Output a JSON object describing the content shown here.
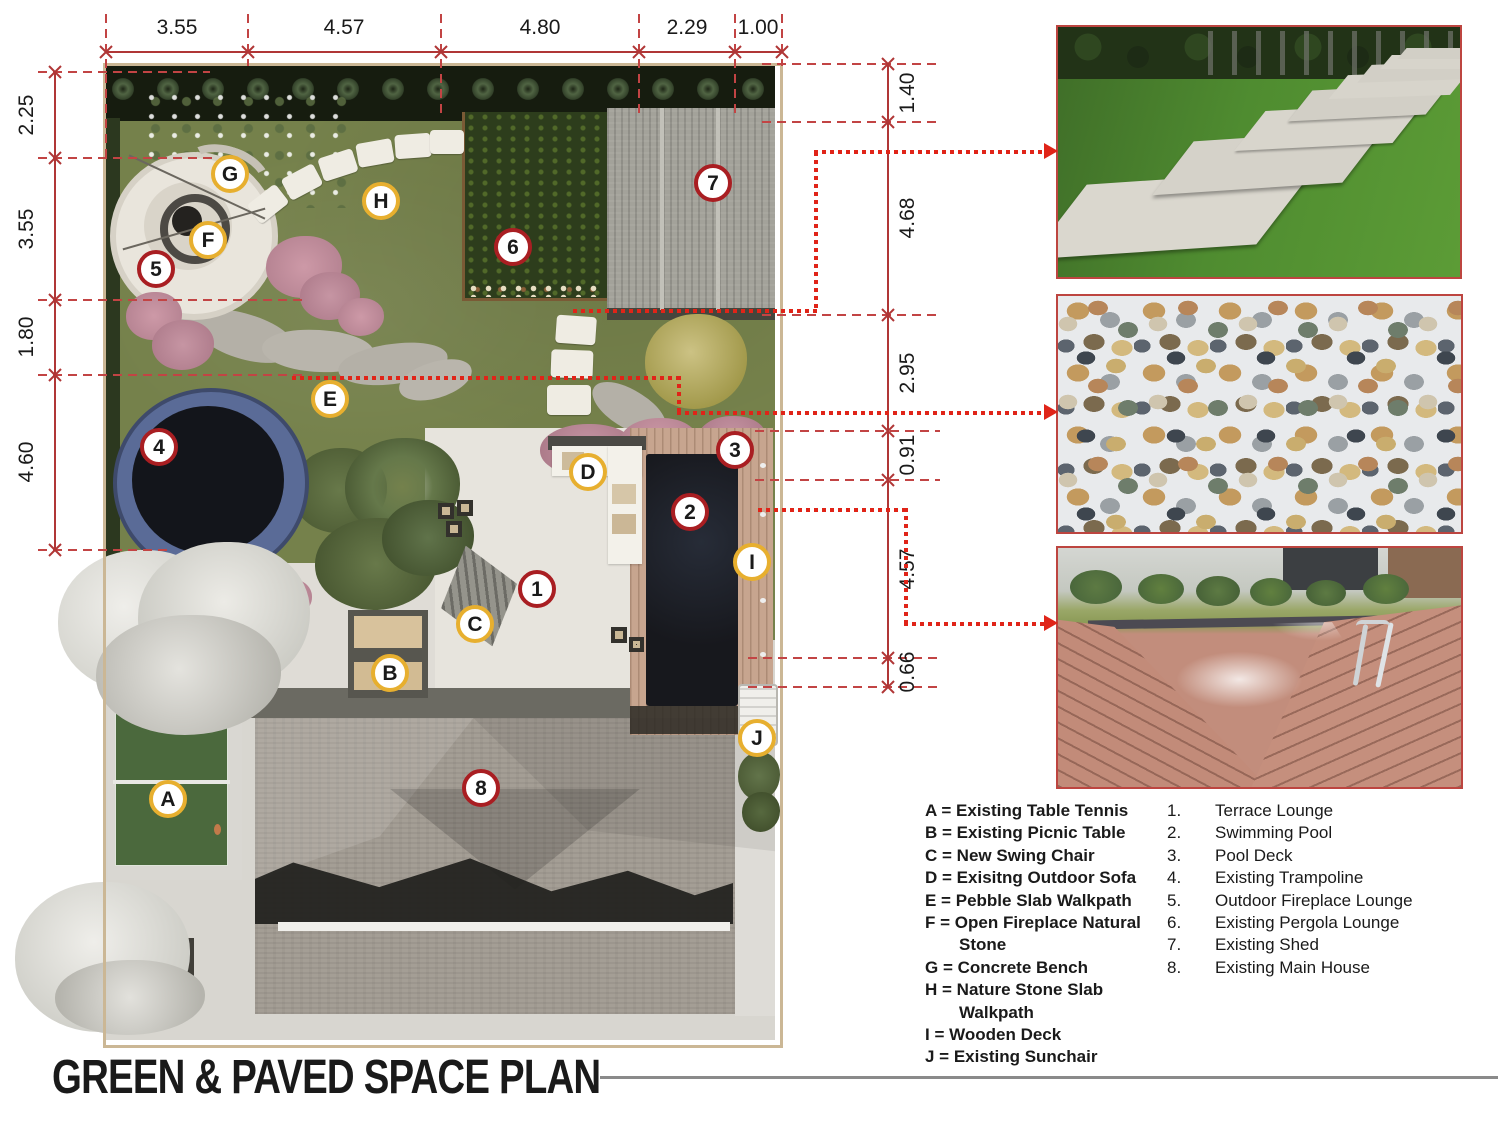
{
  "title": "GREEN & PAVED SPACE PLAN",
  "dimensions": {
    "top": [
      "3.55",
      "4.57",
      "4.80",
      "2.29",
      "1.00"
    ],
    "left": [
      "2.25",
      "3.55",
      "1.80",
      "4.60"
    ],
    "right": [
      "1.40",
      "4.68",
      "2.95",
      "0.91",
      "4.57",
      "0.66"
    ]
  },
  "markers": {
    "numbered": [
      "1",
      "2",
      "3",
      "4",
      "5",
      "6",
      "7",
      "8"
    ],
    "lettered": [
      "A",
      "B",
      "C",
      "D",
      "E",
      "F",
      "G",
      "H",
      "I",
      "J"
    ]
  },
  "legend_letters": [
    {
      "k": "A =",
      "t": "Existing Table Tennis"
    },
    {
      "k": "B =",
      "t": "Existing Picnic Table"
    },
    {
      "k": "C =",
      "t": "New Swing Chair"
    },
    {
      "k": "D =",
      "t": "Exisitng Outdoor Sofa"
    },
    {
      "k": "E =",
      "t": "Pebble Slab Walkpath"
    },
    {
      "k": "F =",
      "t": "Open Fireplace Natural Stone"
    },
    {
      "k": "G =",
      "t": "Concrete Bench"
    },
    {
      "k": "H =",
      "t": "Nature Stone Slab Walkpath"
    },
    {
      "k": "I =",
      "t": "Wooden Deck"
    },
    {
      "k": "J =",
      "t": "Existing Sunchair"
    }
  ],
  "legend_numbers": [
    {
      "k": "1.",
      "t": "Terrace Lounge"
    },
    {
      "k": "2.",
      "t": "Swimming Pool"
    },
    {
      "k": "3.",
      "t": "Pool Deck"
    },
    {
      "k": "4.",
      "t": "Existing Trampoline"
    },
    {
      "k": "5.",
      "t": "Outdoor Fireplace Lounge"
    },
    {
      "k": "6.",
      "t": "Existing Pergola Lounge"
    },
    {
      "k": "7.",
      "t": "Existing Shed"
    },
    {
      "k": "8.",
      "t": "Existing Main House"
    }
  ],
  "photos": [
    "stone-paver-walkway-photo",
    "pebble-mosaic-photo",
    "swimming-pool-deck-photo"
  ],
  "colors": {
    "marker_number_ring": "#a91e22",
    "marker_letter_ring": "#e7af2f",
    "leader_arrow_red": "#e02418",
    "dimension_red": "#b03636",
    "photo_border_red": "#bd4540",
    "title_line_gray": "#8a8a8a"
  }
}
